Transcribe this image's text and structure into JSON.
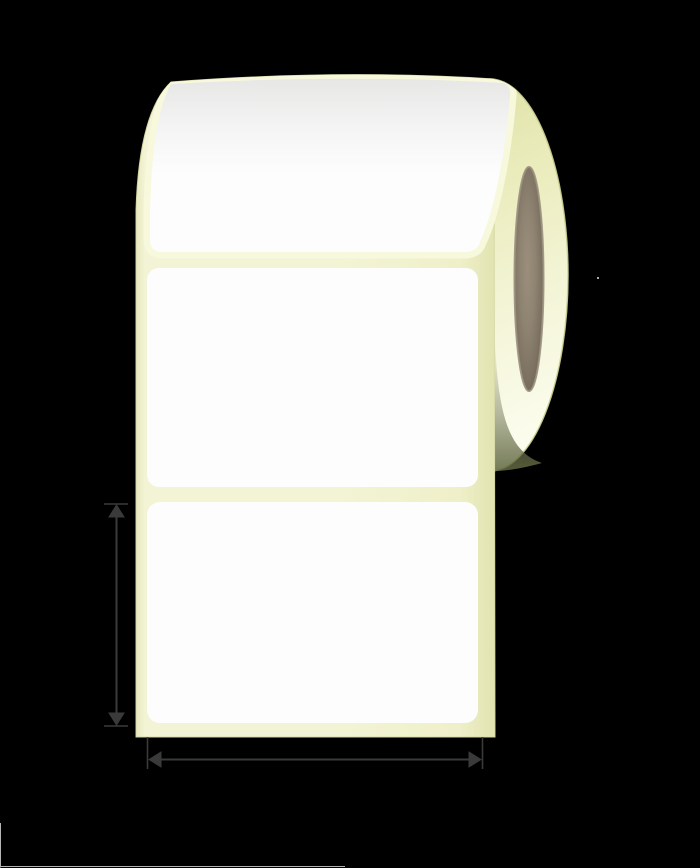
{
  "image": {
    "kind": "product-illustration",
    "subject": "blank rectangular label roll with height and width dimension arrows",
    "visible_text": "",
    "labels_visible_count": "3"
  },
  "colors": {
    "bg": "#000000",
    "strip_fill_edge": "#e8e9c0",
    "strip_fill_main": "#f3f4d5",
    "strip_fill_soft": "#eff0c9",
    "strip_fill_right": "#e1e3b0",
    "strip_stroke": "rgba(214,216,168,0.95)",
    "halo": "#f7f8dc",
    "label_white": "#fdfdfd",
    "label_shade_strong": "rgba(95,95,88,0.14)",
    "label_shade_mid": "rgba(95,95,88,0.05)",
    "label_shade_none": "rgba(95,95,88,0)",
    "ellipse_top": "#dde0a2",
    "ellipse_mid1": "#eaecbc",
    "ellipse_mid2": "#f3f4d5",
    "ellipse_bottom": "#fbfcec",
    "ellipse_stroke": "rgba(205,208,150,0.9)",
    "shadow_none": "rgba(100,106,68,0)",
    "shadow_mid": "rgba(100,106,68,0.45)",
    "shadow_strong": "rgba(98,104,66,0.88)",
    "core_light": "#9b8f7c",
    "core_mid": "#8e8271",
    "core_deep": "#7d7261",
    "core_dark": "#6e6453",
    "core_rim": "rgba(154,144,128,0.9)",
    "arrow": "#3a3a3a",
    "dot": "#ababab",
    "faint_line": "#b5b5b5"
  },
  "annotations": {
    "height_arrow": "vertical-double-headed-dimension-arrow",
    "width_arrow": "horizontal-double-headed-dimension-arrow"
  }
}
